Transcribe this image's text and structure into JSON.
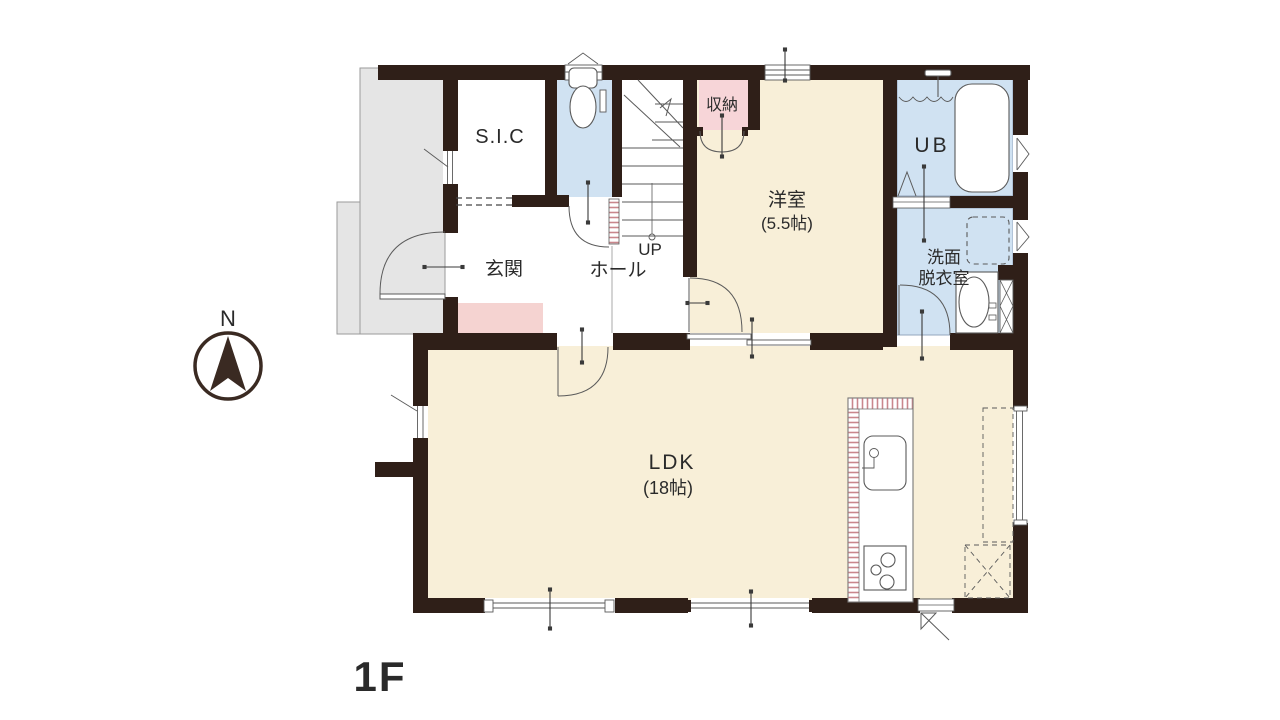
{
  "floor_label": "1F",
  "compass": {
    "north_label": "N"
  },
  "rooms": {
    "sic": "S.I.C",
    "genkan": "玄関",
    "hall": "ホール",
    "stairs_up": "UP",
    "closet": "収納",
    "western_room": "洋室",
    "western_room_size": "(5.5帖)",
    "unit_bath": "UB",
    "washroom_line1": "洗面",
    "washroom_line2": "脱衣室",
    "ldk": "LDK",
    "ldk_size": "(18帖)"
  },
  "colors": {
    "wall": "#2f1f18",
    "floor_cream": "#f8efd8",
    "floor_blue": "#d0e2f2",
    "floor_pink": "#f7d5d8",
    "mat_pink": "#f5d3d1",
    "porch_gray": "#e5e5e5",
    "label_text": "#2a2a2a",
    "line": "#5a5a5a",
    "stripe": "#c9868c"
  }
}
